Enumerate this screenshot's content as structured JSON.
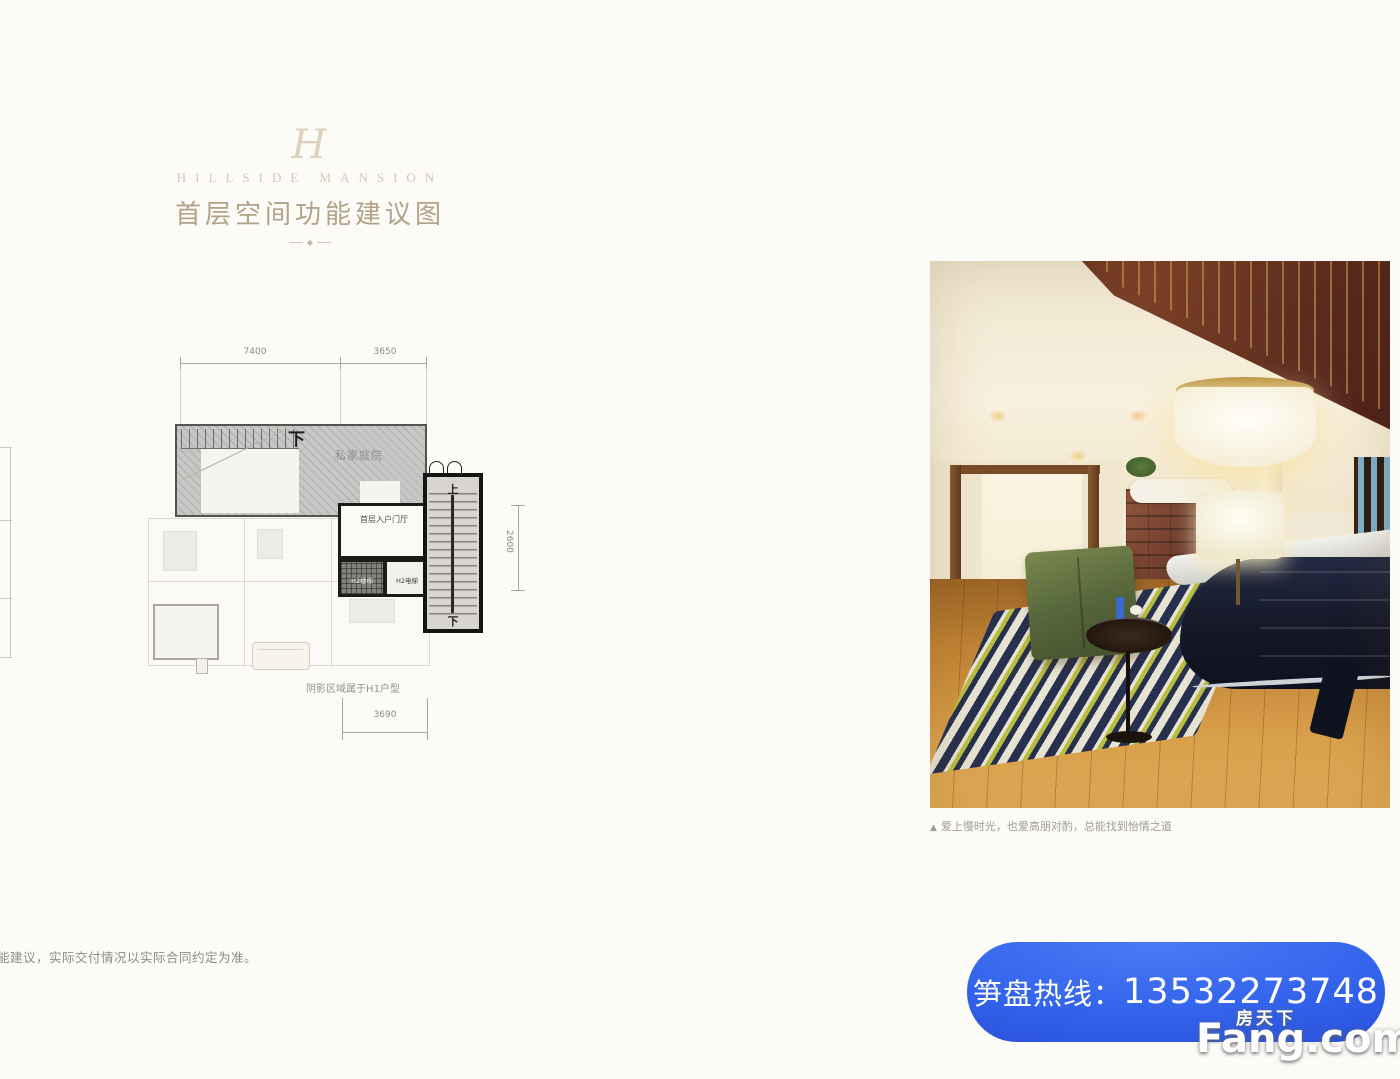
{
  "header": {
    "monogram": "H",
    "brand": "HILLSIDE MANSION",
    "title": "首层空间功能建议图",
    "ornament": "◆"
  },
  "floorplan": {
    "dim_top_left": "7400",
    "dim_top_right": "3650",
    "dim_right": "2600",
    "dim_bottom": "3690",
    "label_down_courtyard": "下",
    "label_up": "上",
    "label_down_stair": "下",
    "courtyard_label": "私家庭院",
    "entrance_label": "首层入户门厅",
    "stair_room_label": "H2楼梯",
    "elevator_room_label": "H2电梯",
    "note": "阴影区域属于H1户型"
  },
  "disclaimer": "功能建议，实际交付情况以实际合同约定为准。",
  "photo": {
    "caption_marker": "▲",
    "caption": "爱上慢时光，也爱高朋对酌，总能找到怡情之道"
  },
  "hotline": {
    "label": "笋盘热线：",
    "number": "13532273748"
  },
  "watermark": {
    "cn": "房天下",
    "en": "Fang.com"
  },
  "colors": {
    "banner_blue": "#3161ea",
    "title_gold": "#ab997b",
    "plan_dark": "#1b1b19"
  }
}
